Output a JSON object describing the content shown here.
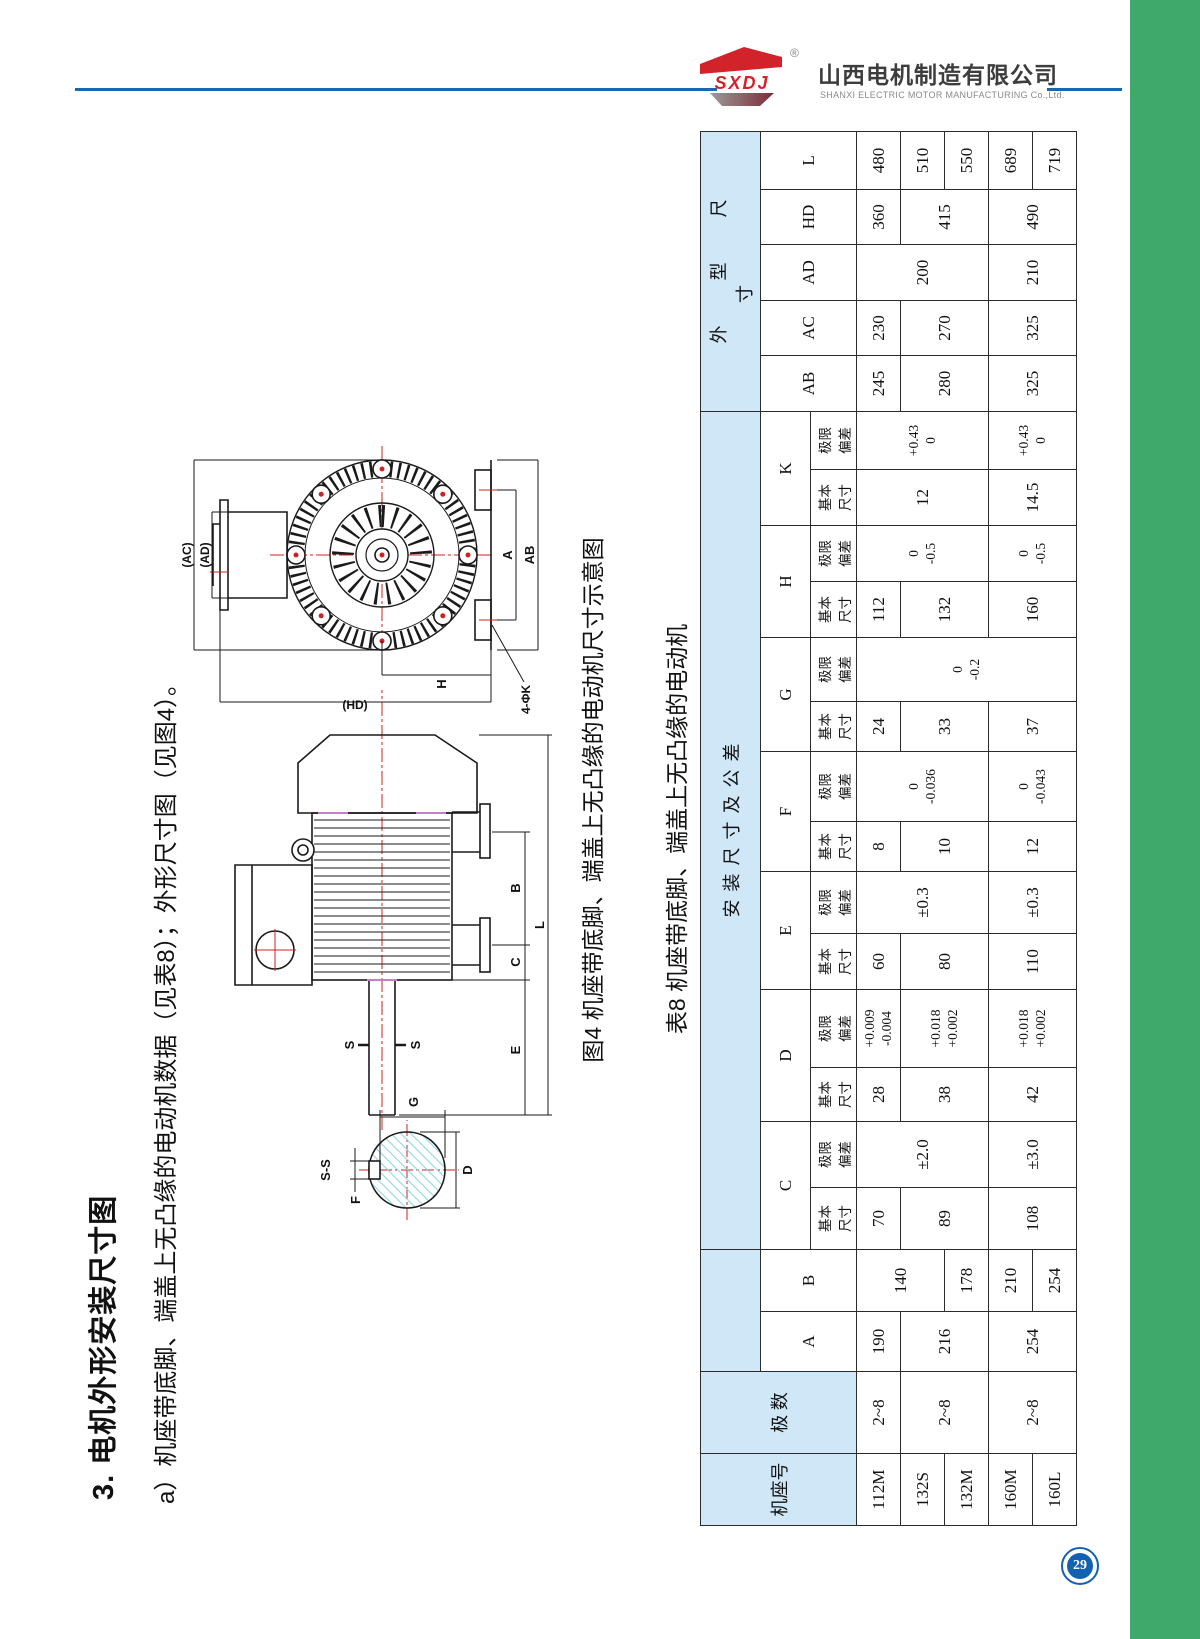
{
  "page": {
    "number": "29",
    "accent_green": "#3FA96B",
    "accent_blue": "#1A67B0",
    "table_header_blue": "#CFE7F7",
    "logo_red": "#D2232A"
  },
  "header": {
    "logo_text": "SXDJ",
    "registered": "®",
    "company_cn": "山西电机制造有限公司",
    "company_en": "SHANXI ELECTRIC MOTOR MANUFACTURING Co.,Ltd."
  },
  "content": {
    "section_title": "3. 电机外形安装尺寸图",
    "subtitle": "a）机座带底脚、端盖上无凸缘的电动机数据（见表8）；外形尺寸图（见图4）。",
    "figure_caption": "图4 机座带底脚、端盖上无凸缘的电动机尺寸示意图",
    "table_caption": "表8 机座带底脚、端盖上无凸缘的电动机"
  },
  "drawing": {
    "labels": {
      "ac": "(AC)",
      "ad": "(AD)",
      "hd": "(HD)",
      "h": "H",
      "k4": "4-ΦK",
      "a": "A",
      "ab": "AB",
      "b": "B",
      "c": "C",
      "e": "E",
      "l": "L",
      "s1": "S",
      "s2": "S",
      "ss": "S-S",
      "f": "F",
      "g": "G",
      "d": "D"
    }
  },
  "table": {
    "col_frame": "机座号",
    "col_poles": "极 数",
    "group_install": "安装尺寸及公差",
    "group_outline": "外型尺寸",
    "basic": "基本\n尺寸",
    "deviation": "极限\n偏差",
    "dims": [
      "A",
      "B",
      "C",
      "D",
      "E",
      "F",
      "G",
      "H",
      "K"
    ],
    "outline_dims": [
      "AB",
      "AC",
      "AD",
      "HD",
      "L"
    ],
    "col_widths": [
      72,
      82,
      60,
      62,
      62,
      66,
      54,
      78,
      56,
      62,
      50,
      70,
      50,
      64,
      56,
      56,
      56,
      58,
      56,
      55,
      56,
      55,
      58
    ],
    "rows": [
      [
        "112M",
        "2~8",
        "190",
        {
          "v": "140",
          "rs": 2
        },
        "70",
        {
          "v": "±2.0",
          "rs": 3
        },
        "28",
        "+0.009\n-0.004",
        "60",
        {
          "v": "±0.3",
          "rs": 3
        },
        "8",
        {
          "v": "0\n-0.036",
          "rs": 3
        },
        "24",
        {
          "v": "0\n-0.2",
          "rs": 5
        },
        "112",
        {
          "v": "0\n-0.5",
          "rs": 3
        },
        {
          "v": "12",
          "rs": 3
        },
        {
          "v": "+0.43\n0",
          "rs": 3
        },
        "245",
        "230",
        {
          "v": "200",
          "rs": 3
        },
        "360",
        "480"
      ],
      [
        "132S",
        {
          "v": "2~8",
          "rs": 2
        },
        {
          "v": "216",
          "rs": 2
        },
        {
          "v": "89",
          "rs": 2
        },
        {
          "v": "38",
          "rs": 2
        },
        {
          "v": "+0.018\n+0.002",
          "rs": 2
        },
        {
          "v": "80",
          "rs": 2
        },
        {
          "v": "10",
          "rs": 2
        },
        {
          "v": "33",
          "rs": 2
        },
        {
          "v": "132",
          "rs": 2
        },
        {
          "v": "280",
          "rs": 2
        },
        {
          "v": "270",
          "rs": 2
        },
        {
          "v": "415",
          "rs": 2
        },
        "510"
      ],
      [
        "132M",
        "178",
        "550"
      ],
      [
        "160M",
        {
          "v": "2~8",
          "rs": 2
        },
        {
          "v": "254",
          "rs": 2
        },
        "210",
        {
          "v": "108",
          "rs": 2
        },
        {
          "v": "±3.0",
          "rs": 2
        },
        {
          "v": "42",
          "rs": 2
        },
        {
          "v": "+0.018\n+0.002",
          "rs": 2
        },
        {
          "v": "110",
          "rs": 2
        },
        {
          "v": "±0.3",
          "rs": 2
        },
        {
          "v": "12",
          "rs": 2
        },
        {
          "v": "0\n-0.043",
          "rs": 2
        },
        {
          "v": "37",
          "rs": 2
        },
        {
          "v": "160",
          "rs": 2
        },
        {
          "v": "0\n-0.5",
          "rs": 2
        },
        {
          "v": "14.5",
          "rs": 2
        },
        {
          "v": "+0.43\n0",
          "rs": 2
        },
        {
          "v": "325",
          "rs": 2
        },
        {
          "v": "325",
          "rs": 2
        },
        {
          "v": "210",
          "rs": 2
        },
        {
          "v": "490",
          "rs": 2
        },
        "689"
      ],
      [
        "160L",
        "254",
        "719"
      ]
    ]
  }
}
